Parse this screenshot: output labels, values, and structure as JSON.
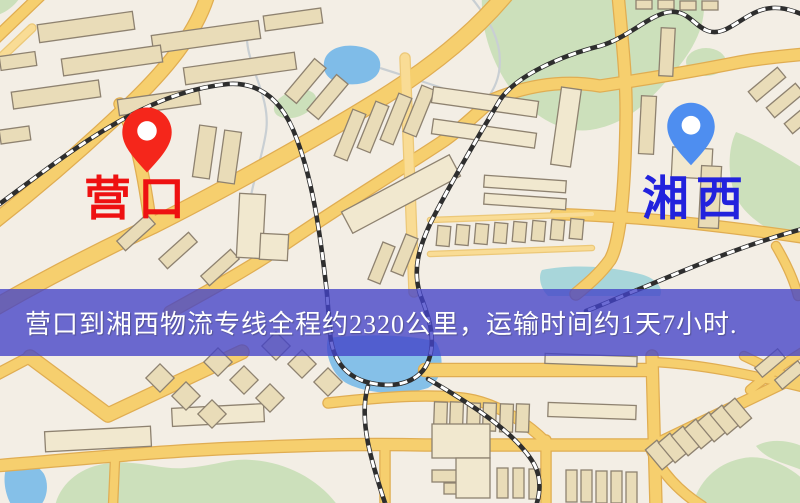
{
  "map": {
    "origin": {
      "label": "营口",
      "pin_color": "#f5261b",
      "label_color": "#ee1111"
    },
    "destination": {
      "label": "湘西",
      "pin_color": "#4e8ef0",
      "label_color": "#2222dd"
    },
    "banner": {
      "text": "营口到湘西物流专线全程约2320公里，运输时间约1天7小时.",
      "background": "#4242c8",
      "text_color": "#ffffff"
    },
    "route": {
      "origin_city": "营口",
      "destination_city": "湘西",
      "distance_km": "2320",
      "duration": "1天7小时"
    }
  }
}
